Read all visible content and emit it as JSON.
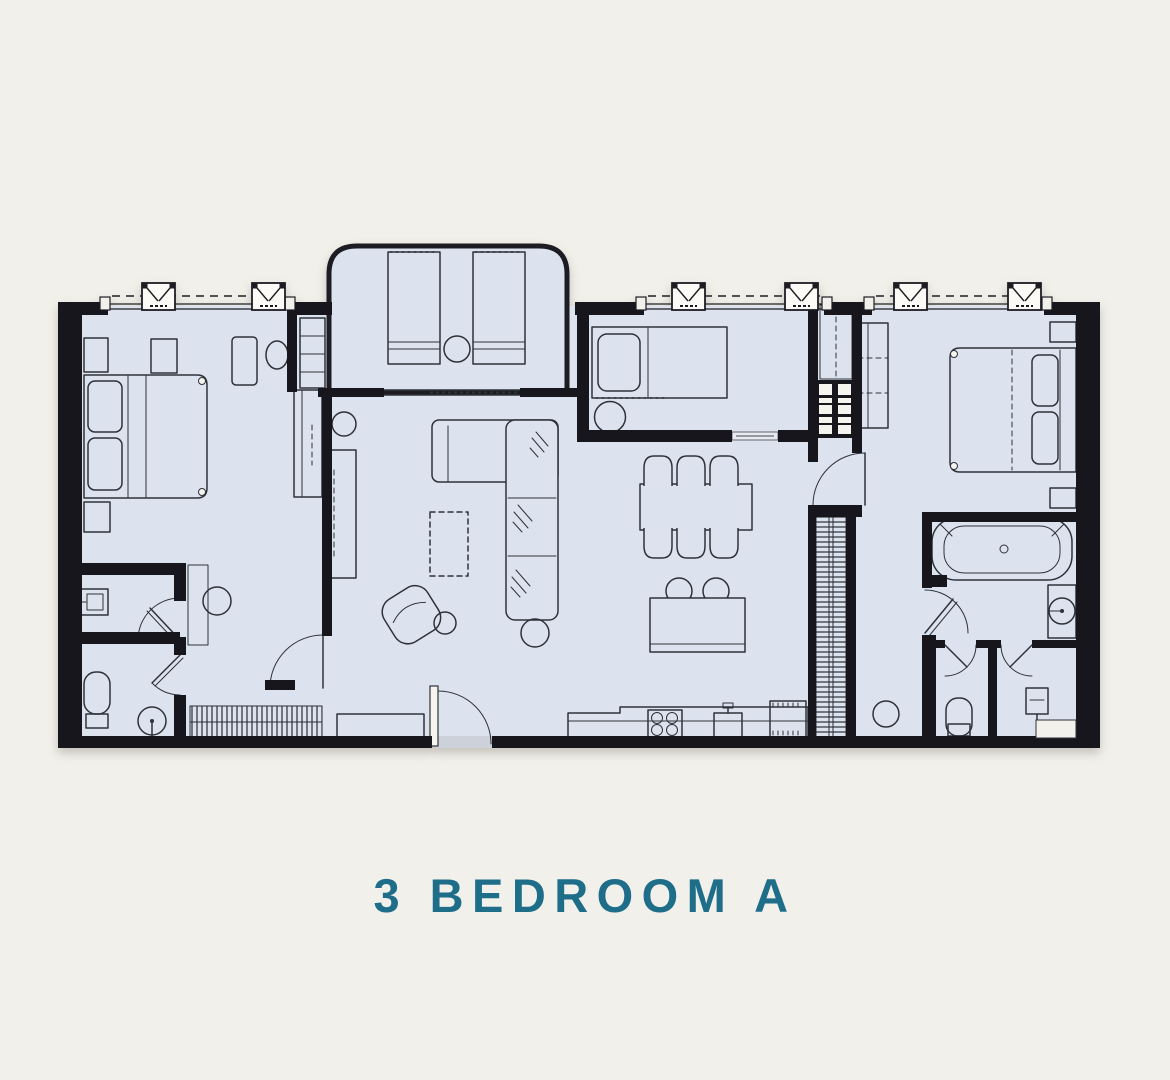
{
  "title": {
    "text": "3 BEDROOM A"
  },
  "colors": {
    "background": "#f2f0ea",
    "floor": "#dce3ee",
    "wall": "#17171b",
    "furniture_line": "#2e3138",
    "title_accent": "#1e6d89"
  },
  "floorplan": {
    "name": "3 Bedroom A floor plan",
    "icon_names": [
      "double-bed-icon",
      "single-bed-icon",
      "pillow-icon",
      "nightstand-icon",
      "wardrobe-icon",
      "walk-in-closet-icon",
      "washer-dryer-icon",
      "bathtub-icon",
      "shower-icon",
      "toilet-icon",
      "washbasin-icon",
      "pedestal-sink-icon",
      "sofa-l-shaped-icon",
      "armchair-icon",
      "pouf-icon",
      "coffee-table-icon",
      "tv-console-icon",
      "sideboard-icon",
      "dining-table-icon",
      "dining-chair-icon",
      "kitchen-island-icon",
      "bar-stool-icon",
      "cooktop-icon",
      "kitchen-sink-icon",
      "refrigerator-icon",
      "sun-lounger-icon",
      "balcony-table-icon",
      "window-icon",
      "door-swing-icon",
      "sliding-door-icon"
    ]
  }
}
